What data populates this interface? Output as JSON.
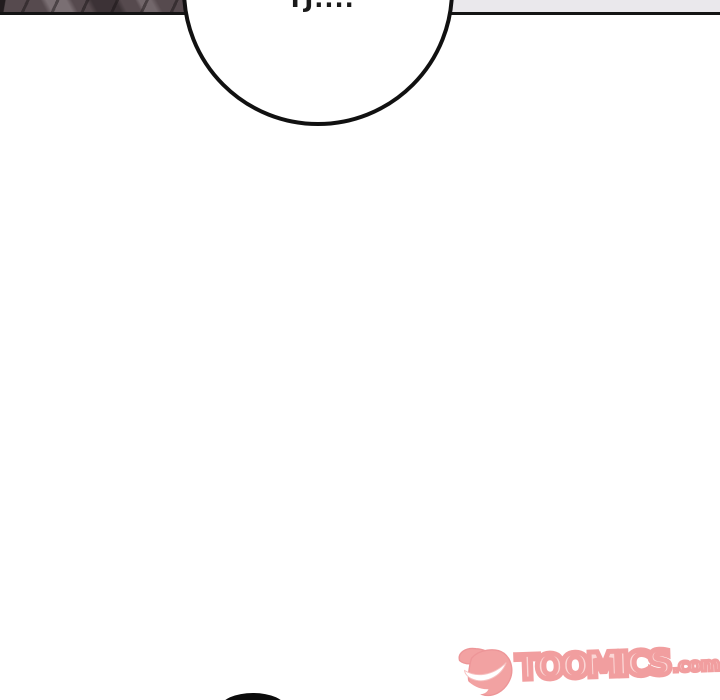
{
  "page": {
    "width": 720,
    "height": 700,
    "background": "#ffffff"
  },
  "top_panel": {
    "artwork_base_color": "#564a4e",
    "artwork_shadow_color": "#221c1e",
    "divider_color": "#141414",
    "right_band_color": "#eae8ec"
  },
  "speech_bubble": {
    "visible_text_fragment": "TJ....",
    "fill": "#ffffff",
    "outline_color": "#111111"
  },
  "bottom_figure": {
    "color": "#0c0c0c"
  },
  "watermark": {
    "wordmark": "TOOMICS",
    "suffix": ".com",
    "primary_color": "#f09798",
    "highlight_color": "#fbd3d2",
    "grin_color": "#ffffff",
    "mascot_icon": "toomics-devil-grin-icon"
  }
}
